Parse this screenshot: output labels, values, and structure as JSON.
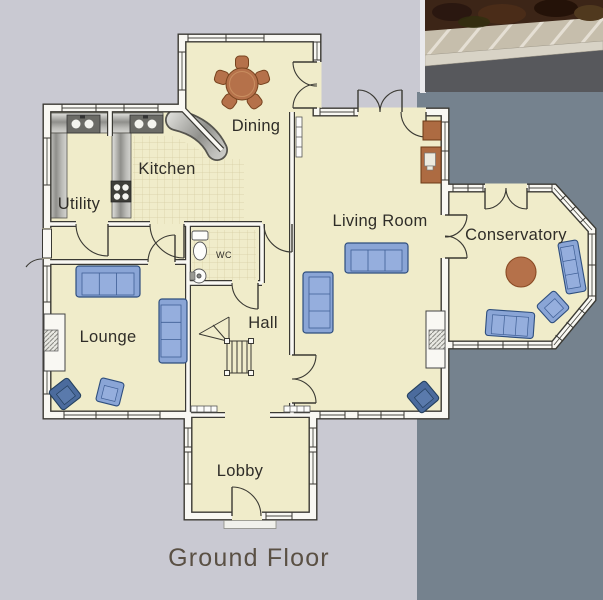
{
  "title": {
    "label": "Ground Floor"
  },
  "rooms": {
    "utility": {
      "label": "Utility"
    },
    "kitchen": {
      "label": "Kitchen"
    },
    "dining": {
      "label": "Dining"
    },
    "living_room": {
      "label": "Living Room"
    },
    "conservatory": {
      "label": "Conservatory"
    },
    "lounge": {
      "label": "Lounge"
    },
    "hall": {
      "label": "Hall"
    },
    "wc": {
      "label": "WC"
    },
    "lobby": {
      "label": "Lobby"
    }
  },
  "colors": {
    "page_light": "#c9c9d2",
    "page_slate": "#75828e",
    "floor_cream": "#f0ecca",
    "wall_white": "#f9f8f3",
    "wall_line": "#3a3933",
    "sofa_blue": "#8aa5d6",
    "armchair_dark_blue": "#4b6b9d",
    "wood_brown": "#b5714a",
    "tile_line": "#d6cea3",
    "title_color": "#5a5044"
  }
}
